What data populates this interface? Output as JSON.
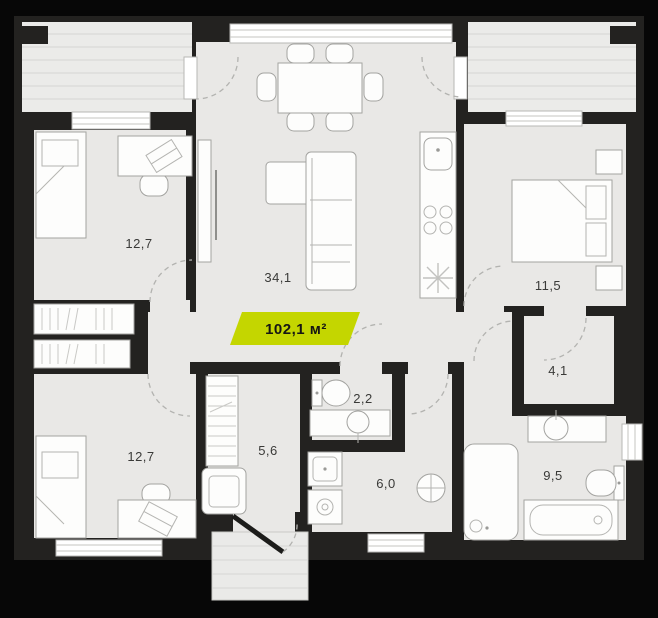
{
  "plan": {
    "total_area": "102,1 м²",
    "accent_color": "#c4d600",
    "background_color": "#070707",
    "wall_color": "#232220",
    "floor_color": "#e9e8e6"
  },
  "rooms": [
    {
      "id": "living-kitchen",
      "area": "34,1"
    },
    {
      "id": "bedroom-top-left",
      "area": "12,7"
    },
    {
      "id": "bedroom-bottom-left",
      "area": "12,7"
    },
    {
      "id": "bedroom-right",
      "area": "11,5"
    },
    {
      "id": "wardrobe-room",
      "area": "4,1"
    },
    {
      "id": "hallway",
      "area": "5,6"
    },
    {
      "id": "wc",
      "area": "2,2"
    },
    {
      "id": "shower-room",
      "area": "6,0"
    },
    {
      "id": "bathroom",
      "area": "9,5"
    }
  ]
}
